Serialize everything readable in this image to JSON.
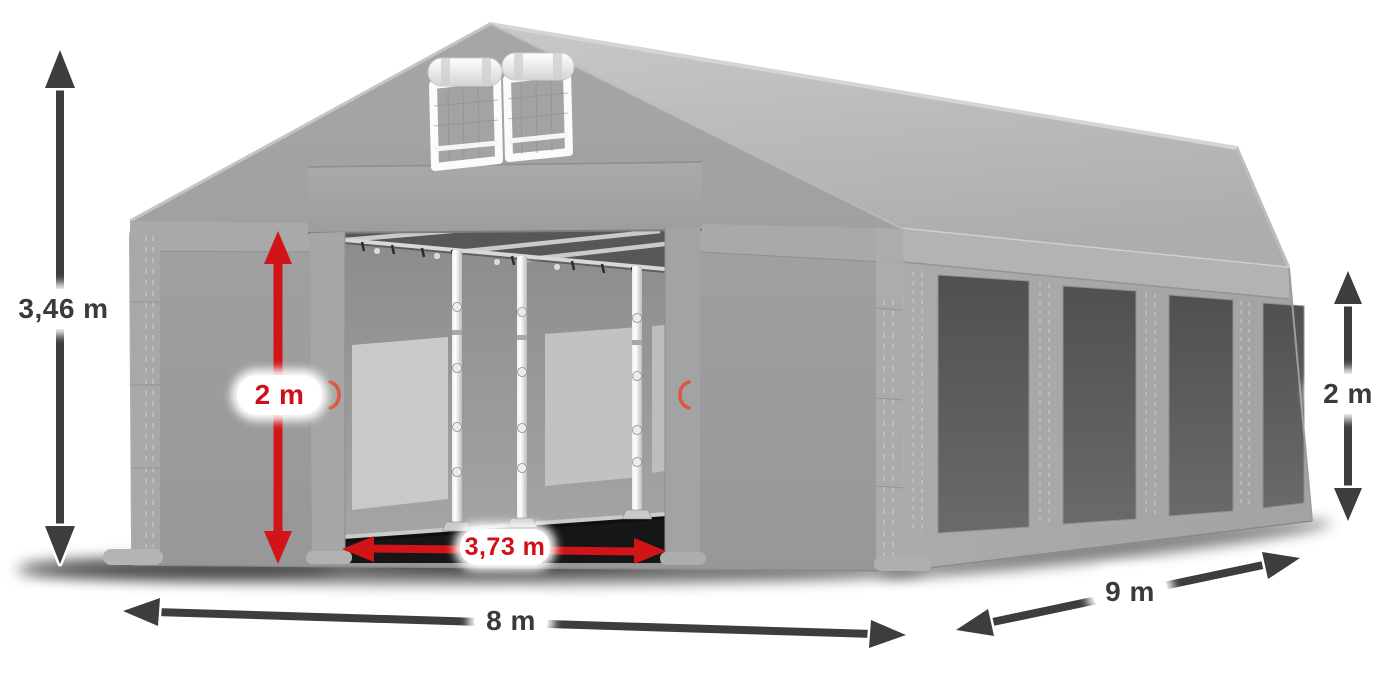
{
  "scene": {
    "description": "3D product illustration of a grey PVC party tent with open front entrance, gable ventilation windows and tinted side windows, annotated with dimension arrows",
    "background": "#ffffff"
  },
  "dimensions": {
    "total_height": {
      "value": "3,46 m",
      "style": "dark"
    },
    "entrance_height": {
      "value": "2 m",
      "style": "red"
    },
    "entrance_width": {
      "value": "3,73 m",
      "style": "red"
    },
    "front_width": {
      "value": "8 m",
      "style": "dark"
    },
    "side_length": {
      "value": "9 m",
      "style": "dark"
    },
    "side_wall_height": {
      "value": "2 m",
      "style": "dark"
    }
  },
  "colors": {
    "tent_body": "#9c9c9c",
    "roof": "#b9bbba",
    "window_tint": "#565656",
    "arrow_dark": "#3d3d3d",
    "arrow_red": "#d11418",
    "label_background": "#ffffff"
  }
}
